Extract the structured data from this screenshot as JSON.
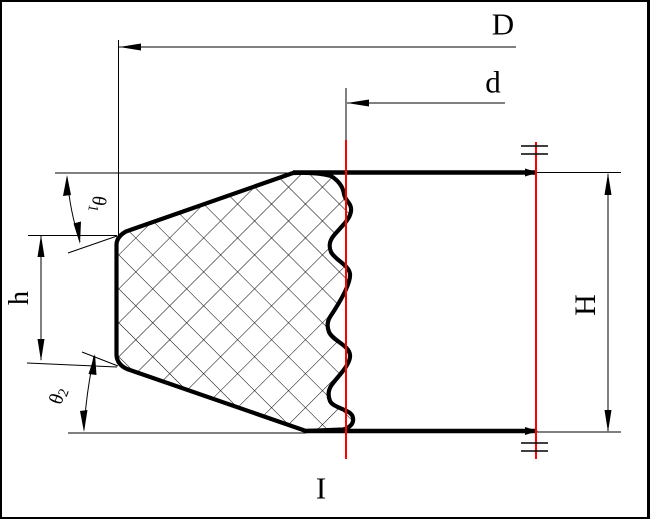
{
  "drawing": {
    "type": "technical-section-drawing",
    "labels": {
      "outer_diameter": "D",
      "inner_diameter": "d",
      "total_height": "H",
      "lip_height": "h",
      "angle1_symbol": "θ",
      "angle1_sub": "1",
      "angle2_symbol": "θ",
      "angle2_sub": "2",
      "section_mark": "I"
    },
    "colors": {
      "line": "#000000",
      "centerline": "#ff0000",
      "background": "#ffffff"
    }
  }
}
